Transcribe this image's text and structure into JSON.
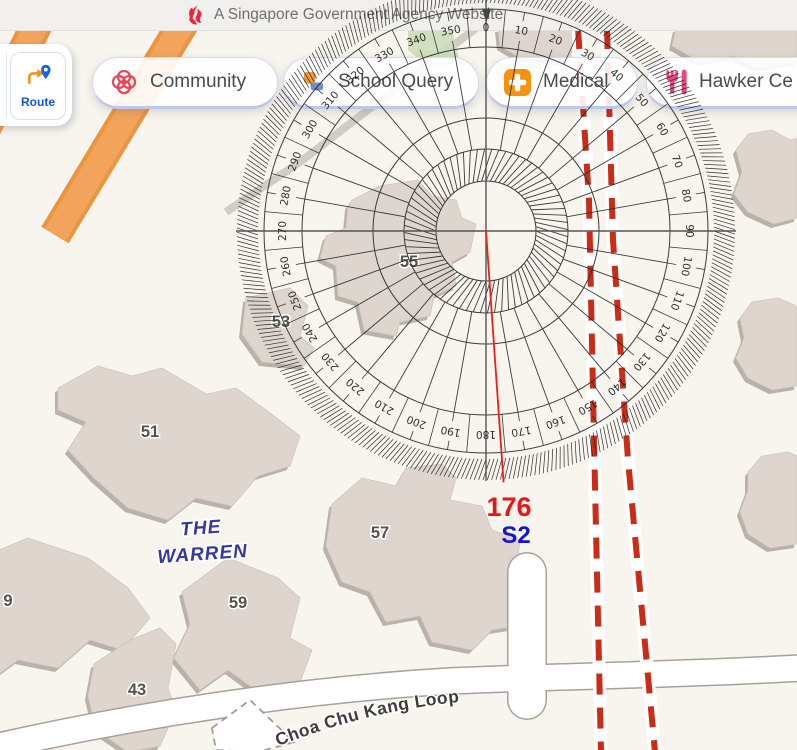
{
  "banner": {
    "text": "A Singapore Government Agency Website"
  },
  "toolbar": {
    "route_label": "Route",
    "buttons": [
      {
        "label": "Community"
      },
      {
        "label": "School Query"
      },
      {
        "label": "Medical"
      },
      {
        "label": "Hawker Ce"
      }
    ]
  },
  "map": {
    "street_label": "Choa Chu Kang Loop",
    "estate_label": [
      "THE",
      "WARREN"
    ],
    "building_labels": [
      "55",
      "53",
      "51",
      "9",
      "59",
      "43",
      "57"
    ],
    "colors": {
      "background": "#f8f4ee",
      "building": "#ddd5ce",
      "building_shadow": "#b9b1aa",
      "road_casing": "#a8a19a",
      "highway_orange": "#f2a45c",
      "boundary_red": "#cb2c15"
    }
  },
  "protractor": {
    "bearing_value": "176",
    "sector_label": "S2",
    "bearing_deg": 176,
    "bearing_color": "#e8151d",
    "sector_color": "#1414d6",
    "tick_labels": [
      "0",
      "10",
      "20",
      "30",
      "40",
      "50",
      "60",
      "70",
      "80",
      "90",
      "100",
      "110",
      "120",
      "130",
      "140",
      "150",
      "160",
      "170",
      "180",
      "190",
      "200",
      "210",
      "220",
      "230",
      "240",
      "250",
      "260",
      "270",
      "280",
      "290",
      "300",
      "310",
      "320",
      "330",
      "340",
      "350"
    ]
  }
}
